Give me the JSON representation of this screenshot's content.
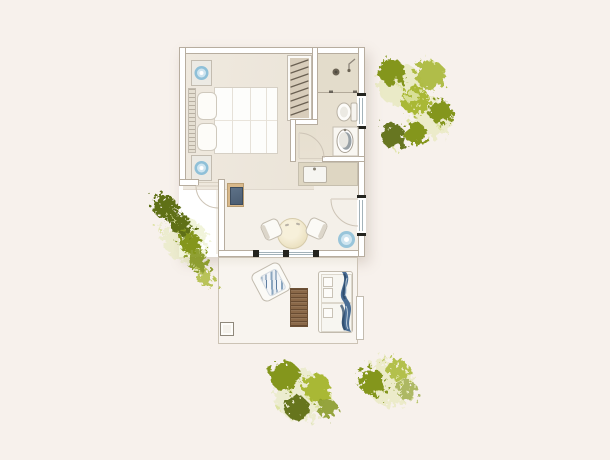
{
  "meta": {
    "type": "architectural-floor-plan-render",
    "view": "top-down",
    "width_px": 610,
    "height_px": 460,
    "visible_text": "none"
  },
  "palette": {
    "bg": "#f7f1ec",
    "wall_fill": "#ffffff",
    "wall_line": "#b7ad9f",
    "soft_line": "#cfc7b9",
    "bedroom_floor": "#efe9df",
    "living_floor": "#f4f0e9",
    "bath_floor": "#e8e1d2",
    "shower_floor": "#e3dccb",
    "counter": "#ded6c2",
    "wood": "#8a6848",
    "wood_dark": "#6d5136",
    "desk_wood": "#d8b88a",
    "desk_panel": "#4b5d72",
    "lamp_blue": "#8fc0d8",
    "lamp_inner": "#cfe5f0",
    "cream_table": "#efe6cb",
    "towel_blue": "#4a6d94",
    "towel_dark": "#2c4a68",
    "towel_light": "#b9cbda",
    "tree_dark": "#5f7013",
    "tree_mid": "#84961f",
    "tree_light": "#a9b836",
    "tree_pale": "#dde3a2",
    "hatch": "#6a6052",
    "frame_black": "#24241f",
    "glass": "#a3b2b9"
  },
  "scene": {
    "rooms": [
      "bedroom",
      "bathroom",
      "hallway-nook",
      "kitchenette",
      "living-dining-area",
      "terrace"
    ],
    "furniture": {
      "bedroom": [
        "double-bed",
        "headboard",
        "two-pillows",
        "quilted-duvet",
        "nightstand-top",
        "nightstand-bottom",
        "round-blue-lamp-top",
        "round-blue-lamp-bottom",
        "built-in-wardrobe-hatched"
      ],
      "bathroom": [
        "walk-in-shower",
        "shower-drain",
        "shower-fixture",
        "toilet",
        "washbasin-on-counter",
        "frosted-window"
      ],
      "kitchenette": [
        "counter",
        "sink-with-faucet"
      ],
      "living-dining-area": [
        "round-dining-table",
        "dining-chair-left",
        "dining-chair-right",
        "side-desk-with-tray",
        "blue-planter-pot",
        "entrance-glazed-door",
        "sliding-glass-wall"
      ],
      "terrace": [
        "outdoor-armchair-with-blue-cushion",
        "wooden-slat-table",
        "double-sun-lounger",
        "draped-blue-towel",
        "planter-box",
        "privacy-wall-segment"
      ]
    },
    "vegetation": [
      "tree-cluster-top-right",
      "tree-cluster-left",
      "tree-cluster-bottom-left",
      "tree-cluster-bottom-right"
    ]
  }
}
